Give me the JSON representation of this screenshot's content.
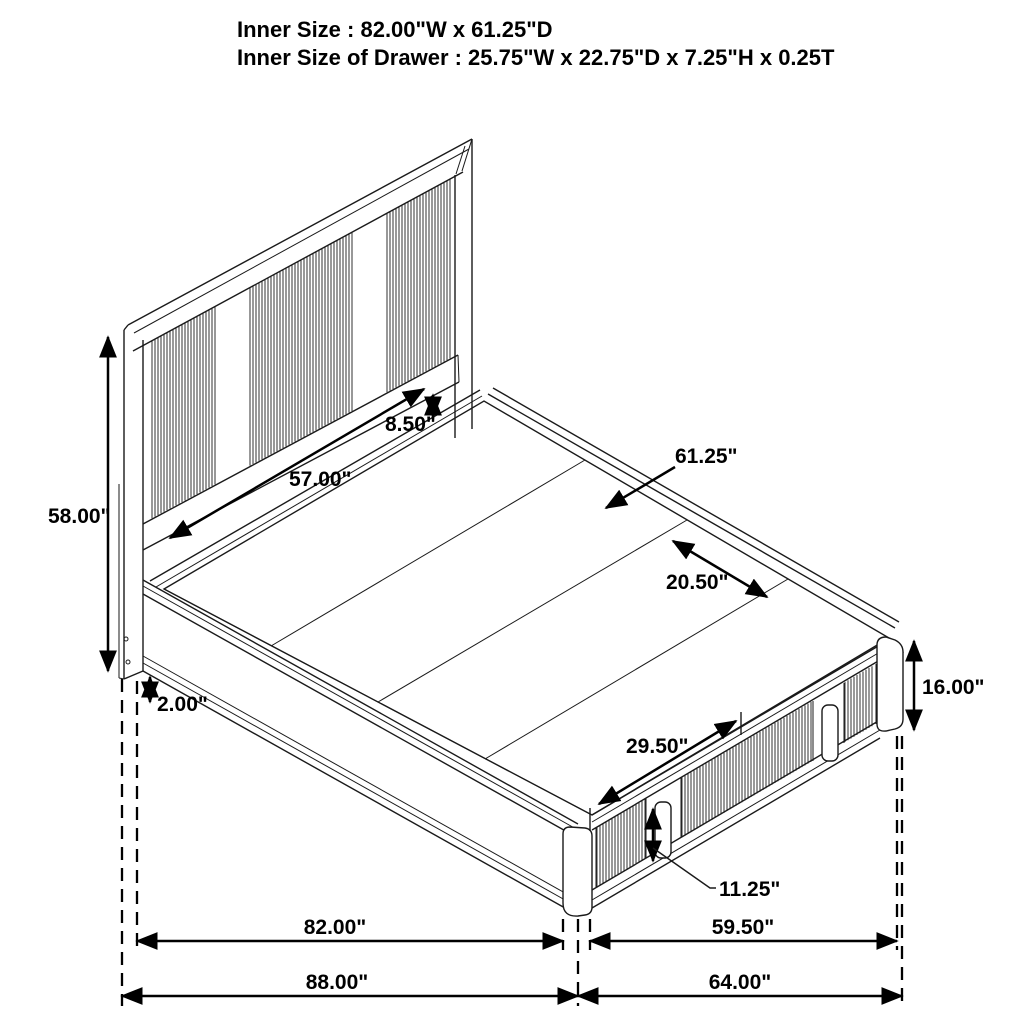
{
  "title": {
    "line1": "Inner Size : 82.00\"W x 61.25\"D",
    "line2": "Inner Size of Drawer : 25.75\"W x 22.75\"D x 7.25\"H x 0.25T"
  },
  "dimensions": {
    "headboard_height": "58.00\"",
    "side_rail_thickness": "2.00\"",
    "headboard_gap": "8.50\"",
    "headboard_inner_width": "57.00\"",
    "inner_depth": "61.25\"",
    "deck_panel_width": "20.50\"",
    "footboard_height": "16.00\"",
    "drawer_span": "29.50\"",
    "drawer_front_height": "11.25\"",
    "inner_length": "82.00\"",
    "footboard_inner_width": "59.50\"",
    "overall_length": "88.00\"",
    "overall_width": "64.00\""
  },
  "colors": {
    "background": "#ffffff",
    "line": "#1a1a1a",
    "dimension": "#000000",
    "text": "#000000"
  }
}
